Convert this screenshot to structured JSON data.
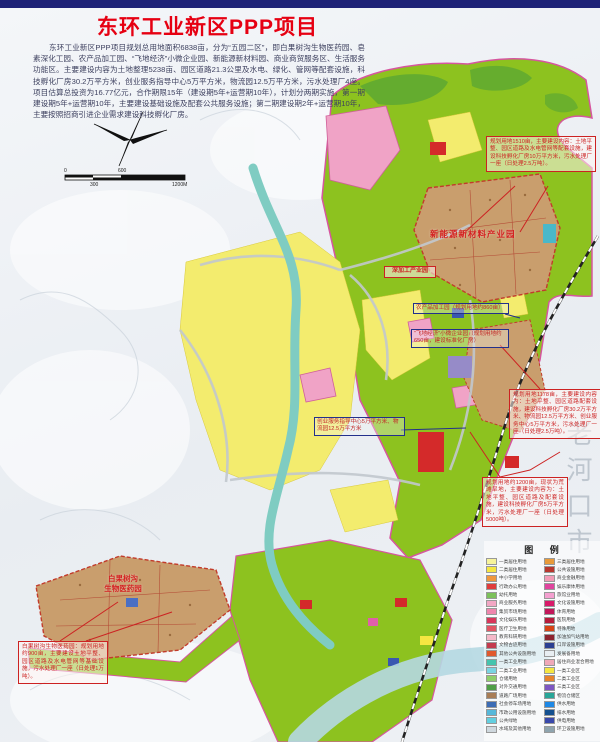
{
  "colors": {
    "title_red": "#e60012",
    "annotation_red": "#cc2222",
    "annotation_blue_border": "#23308c",
    "zone_green": "#8dc21f",
    "zone_yellow": "#f3ec6e",
    "zone_tan": "#c99e6d",
    "zone_pink": "#f0a3c6",
    "river_teal": "#7fccc2",
    "topbar_navy": "#1e2277"
  },
  "header": {
    "title": "东环工业新区PPP项目"
  },
  "intro": {
    "text": "东环工业新区PPP项目规划总用地面积6838亩，分为“五园二区”，即白果树沟生物医药园、皂素深化工园、农产品加工园、“飞地经济”小微企业园、新能源新材料园、商业商贸服务区、生活服务功能区。主要建设内容为土地整理5238亩、园区道路21.3公里及水电、绿化、管网等配套设施，科技孵化厂房30.2万平方米，创业服务指导中心5万平方米，物流园12.5万平方米，污水处理厂4座。项目估算总投资为16.77亿元，合作期限15年（建设期5年+运营期10年），计划分两期实施，第一期建设期5年+运营期10年，主要建设基础设施及配套公共服务设施；第二期建设期2年+运营期10年，主要按照招商引进企业需求建设科技孵化厂房。"
  },
  "scalebar": {
    "zero": "0",
    "mid": "600",
    "half": "300",
    "end": "1200M"
  },
  "map_labels": {
    "new_material_park": "新能源新材料产业园",
    "processing_park": "深加工产业园",
    "biopharma_line1": "白果树沟",
    "biopharma_line2": "生物医药园",
    "city_vertical": "老河口市"
  },
  "annotations": {
    "top_right": "规划用地1510亩，主要建设内容：土地平整、园区道路及水电管网等配套设施，建设科技孵化厂房10万平方米，污水处理厂一座（日处理2.5万吨）。",
    "right_mid": "规划用地1178亩，主要建设内容为：土地平整、园区道路配套设施，建设科技孵化厂房30.2万平方米、物流园12.5万平方米、创业服务中心5万平方米，污水处理厂一座（日处理2.5万吨）。",
    "right_low": "规划用地约1200亩，现状为荒滩旱地，主要建设内容为：土地平整、园区道路及配套设施，建设科技孵化厂房5万平方米，污水处理厂一座（日处理5000吨）。",
    "bottom_left": "白果树沟生物医药园：规划用地约900亩，主要建设土地平整、园区道路及水电管网等基础设施，污水处理厂一座（日处理1万吨）。",
    "blue_1": "农产品加工园（规划用地约860亩）",
    "blue_2": "“飞地经济”小微企业园（规划用地约650亩，建设标准化厂房）",
    "blue_3": "创业服务指导中心5万平方米、物流园12.5万平方米"
  },
  "legend": {
    "title": "图  例",
    "left": [
      {
        "c": "#f7f39b",
        "t": "一类居住用地"
      },
      {
        "c": "#f5e642",
        "t": "二类居住用地"
      },
      {
        "c": "#f0973c",
        "t": "中小学用地"
      },
      {
        "c": "#e03c3c",
        "t": "行政办公用地"
      },
      {
        "c": "#7cc05a",
        "t": "幼托用地"
      },
      {
        "c": "#f2a7c4",
        "t": "商业服务用地"
      },
      {
        "c": "#ef86ad",
        "t": "集贸市场用地"
      },
      {
        "c": "#d8365a",
        "t": "文化娱乐用地"
      },
      {
        "c": "#e25563",
        "t": "医疗卫生用地"
      },
      {
        "c": "#f4b8c8",
        "t": "教育科研用地"
      },
      {
        "c": "#c33b4e",
        "t": "文物古迹用地"
      },
      {
        "c": "#e0592e",
        "t": "其他公共设施用地"
      },
      {
        "c": "#45c4ae",
        "t": "一类工业用地"
      },
      {
        "c": "#7ad4e2",
        "t": "二类工业用地"
      },
      {
        "c": "#8fce6a",
        "t": "仓储用地"
      },
      {
        "c": "#4f9e47",
        "t": "对外交通用地"
      },
      {
        "c": "#a87d56",
        "t": "道路广场用地"
      },
      {
        "c": "#3c6cb4",
        "t": "社会停车场用地"
      },
      {
        "c": "#56b8da",
        "t": "市政公用设施用地"
      },
      {
        "c": "#63cfe0",
        "t": "公共绿地"
      },
      {
        "c": "#cfd8de",
        "t": "水域及其他用地"
      }
    ],
    "right": [
      {
        "c": "#e89a3a",
        "t": "三类居住用地"
      },
      {
        "c": "#b8372e",
        "t": "公共设施用地"
      },
      {
        "c": "#f29bb6",
        "t": "商业金融用地"
      },
      {
        "c": "#e0449e",
        "t": "娱乐康体用地"
      },
      {
        "c": "#f4a0d0",
        "t": "旅馆业用地"
      },
      {
        "c": "#d81b6a",
        "t": "文化设施用地"
      },
      {
        "c": "#c2185b",
        "t": "体育用地"
      },
      {
        "c": "#b71c3c",
        "t": "医院用地"
      },
      {
        "c": "#d84315",
        "t": "特殊用地"
      },
      {
        "c": "#8e2430",
        "t": "加油加气站用地"
      },
      {
        "c": "#2a3f92",
        "t": "口岸设施用地"
      },
      {
        "c": "#e8eef2",
        "t": "发展备用地"
      },
      {
        "c": "#f0a8b8",
        "t": "居住商业混合用地"
      },
      {
        "c": "#f5e642",
        "t": "一类工业区"
      },
      {
        "c": "#e8832c",
        "t": "二类工业区"
      },
      {
        "c": "#7e57c2",
        "t": "三类工业区"
      },
      {
        "c": "#2aa698",
        "t": "物流仓储区"
      },
      {
        "c": "#1e88e5",
        "t": "供水用地"
      },
      {
        "c": "#15508f",
        "t": "排水用地"
      },
      {
        "c": "#3949ab",
        "t": "供电用地"
      },
      {
        "c": "#8fa4ae",
        "t": "环卫设施用地"
      }
    ]
  }
}
